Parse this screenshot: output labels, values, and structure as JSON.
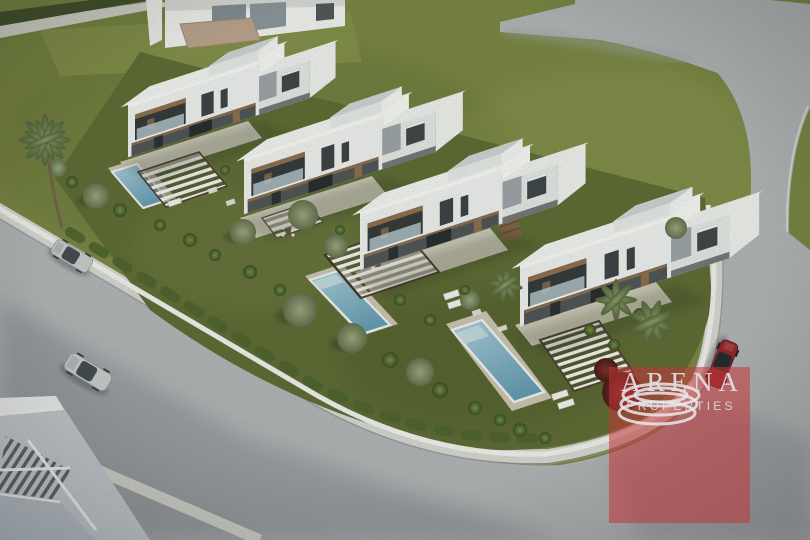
{
  "watermark": {
    "brand": "ARENA",
    "subtitle": "PROPERTIES",
    "logo_icon": "concentric-rings-icon"
  },
  "palette": {
    "grass": "#76833f",
    "garden": "#5a672f",
    "hedge": "#3c4a26",
    "road": "#b0b3b6",
    "roadShadow": "#7e858c",
    "sidewalk": "#d6d7d2",
    "wall": "#f0f1ef",
    "villa": "#f1f3f1",
    "villaShade": "#e4e7e6",
    "accentGrey": "#9aa1a7",
    "darkOpening": "#2e3336",
    "wood": "#85674a",
    "deck": "#d8d3c6",
    "pool": "#7fb1c6",
    "poolLight": "#a9cdd9",
    "treeOlive": "#76855c",
    "treeGreen": "#5d7434",
    "palm": "#6d8050",
    "bushRed": "#64231c",
    "carSilver": "#c6cacc",
    "carRed": "#8e2026",
    "watermarkBg": "rgba(197,52,56,0.55)",
    "watermarkText": "#dde1e3"
  }
}
